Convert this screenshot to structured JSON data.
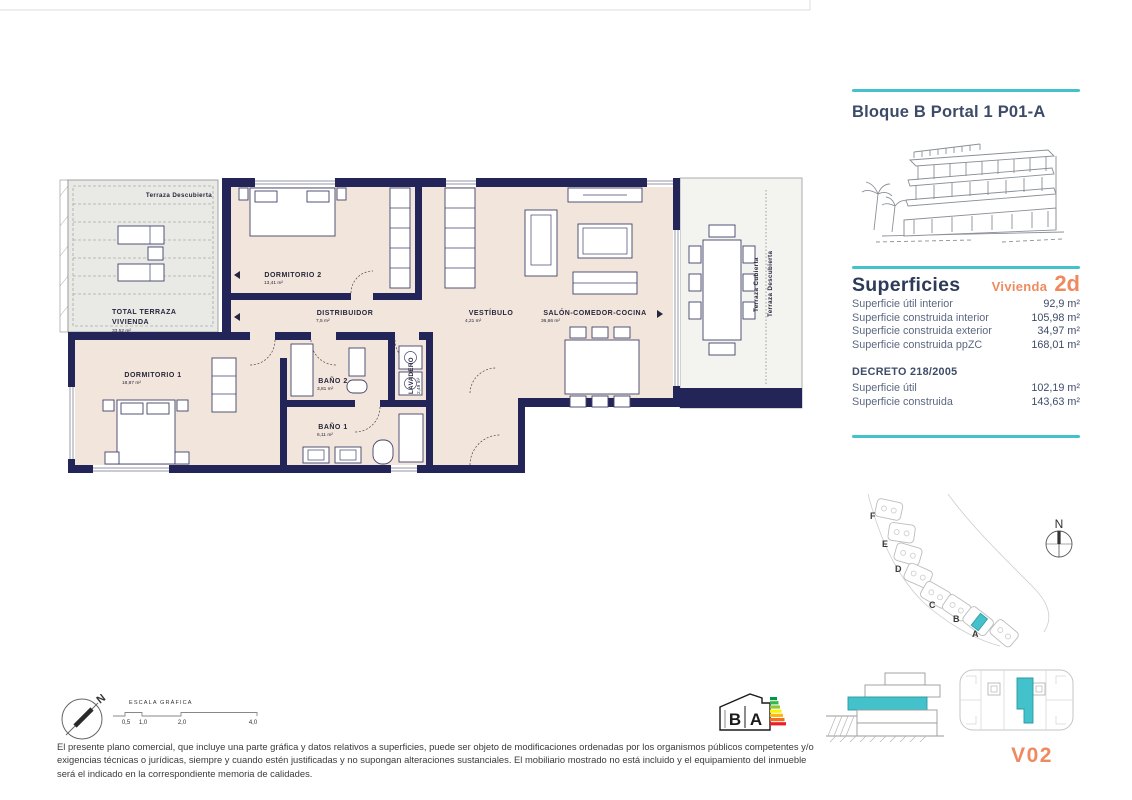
{
  "colors": {
    "teal": "#43c2cb",
    "orange": "#ef8a5f",
    "navy_wall": "#232458",
    "floor_beige": "#f2e5db",
    "terrace_gray": "#e9e9e6",
    "text_navy": "#3e4c68"
  },
  "header": {
    "title": "Bloque B Portal 1 P01-A"
  },
  "superficies": {
    "title": "Superficies",
    "vivienda_label": "Vivienda",
    "vivienda_code": "2d",
    "rows": [
      {
        "label": "Superficie útil interior",
        "value": "92,9 m²"
      },
      {
        "label": "Superficie construida interior",
        "value": "105,98 m²"
      },
      {
        "label": "Superficie construida exterior",
        "value": "34,97 m²"
      },
      {
        "label": "Superficie construida ppZC",
        "value": "168,01 m²"
      }
    ],
    "decreto_title": "DECRETO 218/2005",
    "decreto_rows": [
      {
        "label": "Superficie útil",
        "value": "102,19 m²"
      },
      {
        "label": "Superficie construida",
        "value": "143,63 m²"
      }
    ]
  },
  "plan": {
    "terraza_descubierta": "Terraza Descubierta",
    "total_terraza_line1": "TOTAL TERRAZA",
    "total_terraza_line2": "VIVIENDA",
    "total_terraza_area": "33,52 m²",
    "dormitorio2": {
      "label": "DORMITORIO 2",
      "area": "13,41 m²"
    },
    "distribuidor": {
      "label": "DISTRIBUIDOR",
      "area": "7,5 m²"
    },
    "vestibulo": {
      "label": "VESTÍBULO",
      "area": "4,21 m²"
    },
    "salon": {
      "label": "SALÓN-COMEDOR-COCINA",
      "area": "36,66 m²"
    },
    "dormitorio1": {
      "label": "DORMITORIO 1",
      "area": "18,87 m²"
    },
    "bano2": {
      "label": "BAÑO 2",
      "area": "3,81 m²"
    },
    "bano1": {
      "label": "BAÑO 1",
      "area": "6,11 m²"
    },
    "lavadero": {
      "label": "LAVADERO",
      "area": "2,49 m²"
    },
    "terraza_cubierta": "Terraza Cubierta",
    "terraza_descubierta_right": "Terraza Descubierta"
  },
  "siteplan": {
    "letters": [
      "F",
      "E",
      "D",
      "C",
      "B",
      "A"
    ],
    "north": "N"
  },
  "compass": {
    "north": "N"
  },
  "scalebar": {
    "title": "ESCALA GRÁFICA",
    "ticks": [
      "0,5",
      "1,0",
      "2,0",
      "4,0"
    ]
  },
  "energy": {
    "letter_b": "B",
    "letter_a": "A"
  },
  "unit_key": {
    "label": "V02"
  },
  "footer": {
    "disclaimer": "El presente plano comercial, que incluye una parte gráfica y datos relativos a superficies, puede ser objeto de modificaciones ordenadas por los organismos públicos competentes y/o exigencias técnicas o jurídicas, siempre y cuando estén justificadas y no supongan alteraciones sustanciales. El mobiliario mostrado no está incluido y el equipamiento del inmueble será el indicado en la correspondiente memoria de calidades."
  }
}
